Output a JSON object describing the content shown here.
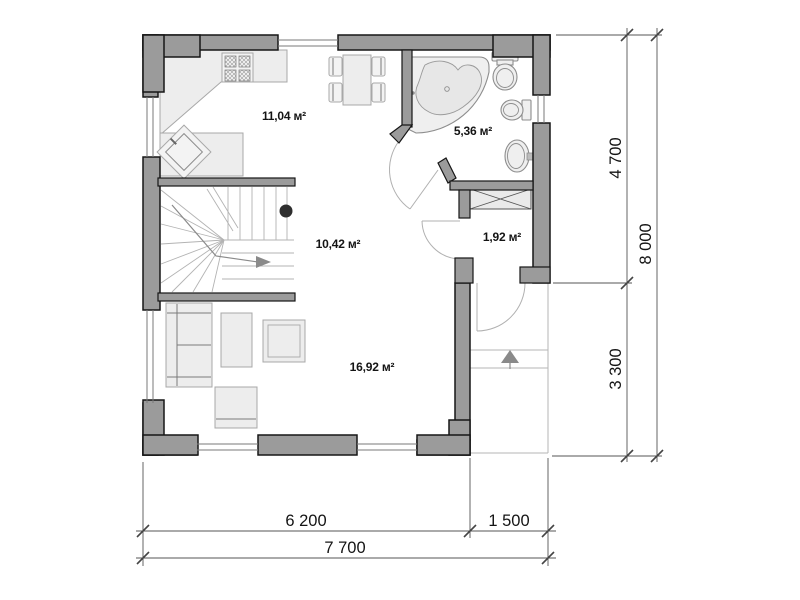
{
  "rooms": {
    "kitchen": "11,04 м²",
    "bathroom": "5,36 м²",
    "hall": "10,42 м²",
    "closet": "1,92 м²",
    "living": "16,92 м²"
  },
  "dimensions": {
    "right_upper": "4 700",
    "right_lower": "3 300",
    "right_total": "8 000",
    "bottom_house": "6 200",
    "bottom_porch": "1 500",
    "bottom_total": "7 700"
  },
  "colors": {
    "wall_fill": "#9b9b9b",
    "wall_outline": "#161616",
    "furniture_fill": "#ededed",
    "dimension_line": "#555555",
    "text": "#141414",
    "background": "#ffffff"
  }
}
